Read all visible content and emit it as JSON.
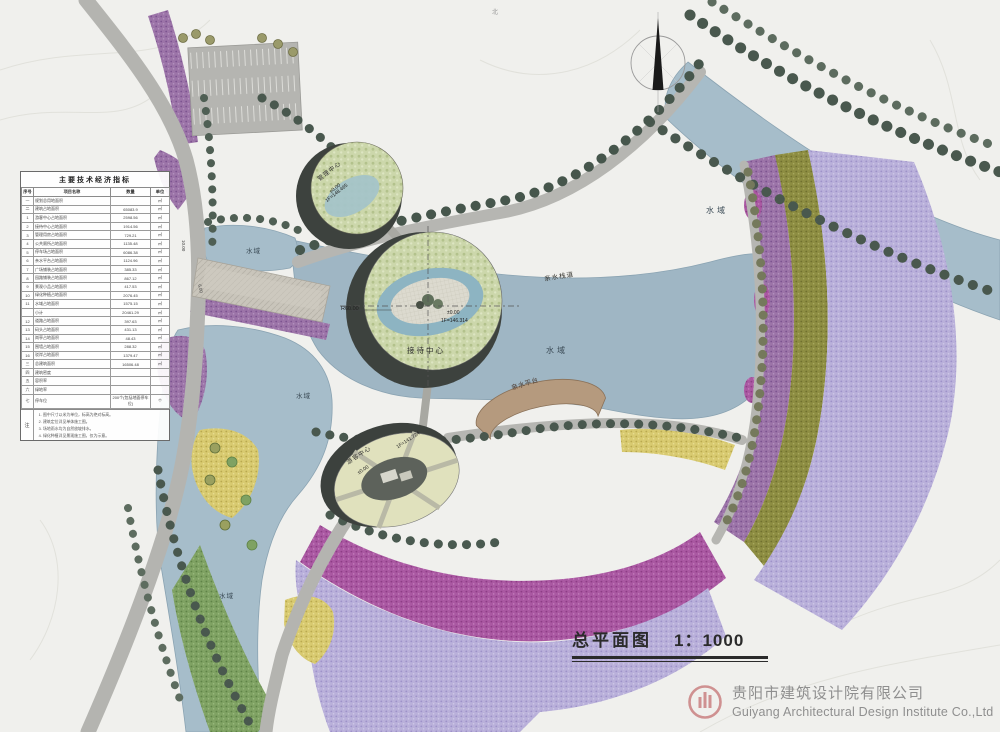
{
  "sheet": {
    "title": "总平面图",
    "scale": "1：1000",
    "company_cn": "贵阳市建筑设计院有限公司",
    "company_en": "Guiyang Architectural Design Institute Co.,Ltd",
    "north_mark": "北"
  },
  "table": {
    "title": "主要技术经济指标",
    "headers": [
      "序号",
      "项目名称",
      "数量",
      "单位"
    ],
    "rows": [
      [
        "一",
        "规划总用地面积",
        "",
        "㎡"
      ],
      [
        "二",
        "建筑占地面积",
        "65083.9",
        "㎡"
      ],
      [
        "1",
        "游客中心占地面积",
        "2598.56",
        "㎡"
      ],
      [
        "2",
        "接待中心占地面积",
        "1914.56",
        "㎡"
      ],
      [
        "3",
        "管理用房占地面积",
        "729.21",
        "㎡"
      ],
      [
        "4",
        "公共厕所占地面积",
        "1135.48",
        "㎡"
      ],
      [
        "5",
        "停车场占地面积",
        "6086.38",
        "㎡"
      ],
      [
        "6",
        "亲水平台占地面积",
        "1124.96",
        "㎡"
      ],
      [
        "7",
        "广场铺装占地面积",
        "385.33",
        "㎡"
      ],
      [
        "8",
        "园路铺装占地面积",
        "867.12",
        "㎡"
      ],
      [
        "9",
        "景观小品占地面积",
        "417.53",
        "㎡"
      ],
      [
        "10",
        "绿化种植占地面积",
        "2076.45",
        "㎡"
      ],
      [
        "11",
        "水域占地面积",
        "1575.15",
        "㎡"
      ],
      [
        "",
        "小计",
        "20461.29",
        "㎡"
      ],
      [
        "12",
        "道路占地面积",
        "397.63",
        "㎡"
      ],
      [
        "13",
        "码头占地面积",
        "431.13",
        "㎡"
      ],
      [
        "14",
        "岗亭占地面积",
        "48.43",
        "㎡"
      ],
      [
        "15",
        "围墙占地面积",
        "288.32",
        "㎡"
      ],
      [
        "16",
        "驳岸占地面积",
        "1379.47",
        "㎡"
      ],
      [
        "三",
        "总建筑面积",
        "16506.48",
        "㎡"
      ],
      [
        "四",
        "建筑密度",
        "",
        ""
      ],
      [
        "五",
        "容积率",
        "",
        ""
      ],
      [
        "六",
        "绿地率",
        "",
        ""
      ],
      [
        "七",
        "停车位",
        "200个(包括地面停车位)",
        "个"
      ]
    ],
    "notes_key": "注",
    "notes": [
      "图中尺寸以米为单位，标高为绝对标高。",
      "建筑定位详见单体施工图。",
      "场地雨水均为自然放坡排水。",
      "绿化种植详见景观施工图，仅为示意。"
    ]
  },
  "map_labels": [
    {
      "name": "water-label-ne",
      "text": "水域",
      "x": 706,
      "y": 207,
      "rot": 0,
      "size": 8,
      "ls": 3,
      "color": "#3a4a55"
    },
    {
      "name": "water-label-center",
      "text": "水域",
      "x": 546,
      "y": 347,
      "rot": 0,
      "size": 8,
      "ls": 3,
      "color": "#3a4a55"
    },
    {
      "name": "water-label-north-pond",
      "text": "水域",
      "x": 246,
      "y": 249,
      "rot": 0,
      "size": 6.5,
      "ls": 1,
      "color": "#3a4a55"
    },
    {
      "name": "water-label-west",
      "text": "水域",
      "x": 296,
      "y": 394,
      "rot": 0,
      "size": 6.5,
      "ls": 1,
      "color": "#3a4a55"
    },
    {
      "name": "water-label-south",
      "text": "水域",
      "x": 219,
      "y": 594,
      "rot": 0,
      "size": 6.5,
      "ls": 1,
      "color": "#3a4a55"
    },
    {
      "name": "boardwalk-label",
      "text": "亲水栈道",
      "x": 544,
      "y": 277,
      "rot": -9,
      "size": 6.5,
      "ls": 1,
      "color": "#33332e"
    },
    {
      "name": "platform-label",
      "text": "亲水平台",
      "x": 511,
      "y": 386,
      "rot": -17,
      "size": 6.5,
      "ls": 0.5,
      "color": "#4a3a30"
    },
    {
      "name": "reception-center-label",
      "text": "接待中心",
      "x": 407,
      "y": 347,
      "rot": 0,
      "size": 7.5,
      "ls": 2,
      "color": "#2e2e2e"
    },
    {
      "name": "radius-label",
      "text": "R60.00",
      "x": 341,
      "y": 307,
      "rot": 0,
      "size": 5.5,
      "ls": 0,
      "color": "#222222"
    },
    {
      "name": "center-elev-label-1",
      "text": "±0.00",
      "x": 447,
      "y": 311,
      "rot": 0,
      "size": 5,
      "ls": 0,
      "color": "#222222"
    },
    {
      "name": "center-elev-label-2",
      "text": "1F=146.314",
      "x": 441,
      "y": 319,
      "rot": 0,
      "size": 5,
      "ls": 0,
      "color": "#222222"
    },
    {
      "name": "management-center-label",
      "text": "管理中心",
      "x": 317,
      "y": 178,
      "rot": -38,
      "size": 6,
      "ls": 1,
      "color": "#2e2e2e"
    },
    {
      "name": "upper-elev-label-1",
      "text": "±0.00",
      "x": 329,
      "y": 191,
      "rot": -38,
      "size": 5,
      "ls": 0,
      "color": "#222222"
    },
    {
      "name": "upper-elev-label-2",
      "text": "1F=148.465",
      "x": 325,
      "y": 200,
      "rot": -38,
      "size": 5,
      "ls": 0,
      "color": "#222222"
    },
    {
      "name": "visitor-center-label",
      "text": "游客中心",
      "x": 346,
      "y": 461,
      "rot": -33,
      "size": 6,
      "ls": 1,
      "color": "#2e2e2e"
    },
    {
      "name": "lower-elev-label-1",
      "text": "±0.00",
      "x": 357,
      "y": 472,
      "rot": -33,
      "size": 5,
      "ls": 0,
      "color": "#222222"
    },
    {
      "name": "lower-elev-label-2",
      "text": "1F=141.724",
      "x": 396,
      "y": 446,
      "rot": -33,
      "size": 5,
      "ls": 0,
      "color": "#222222"
    },
    {
      "name": "road-dim-label-1",
      "text": "10.00",
      "x": 185,
      "y": 240,
      "rot": 90,
      "size": 4.5,
      "ls": 0,
      "color": "#444444"
    },
    {
      "name": "road-dim-label-2",
      "text": "6.00",
      "x": 201,
      "y": 284,
      "rot": 78,
      "size": 4.5,
      "ls": 0,
      "color": "#444444"
    },
    {
      "name": "north-text",
      "text": "北",
      "x": 492,
      "y": 10,
      "rot": 0,
      "size": 6,
      "ls": 0,
      "color": "#999999"
    }
  ],
  "colors": {
    "paper": "#f0f0ed",
    "water": "#a6bdca",
    "road": "#b4b4b0",
    "tree_dark": "#4a5a50",
    "band_purple": "#9c74a8",
    "band_magenta": "#aa58a2",
    "band_lavender": "#b9b0da",
    "band_olive": "#8d8d42",
    "band_yellow": "#d8ca70",
    "band_green": "#7fa263",
    "roof_green": "#ccd7ab",
    "building_shadow": "#3d423e",
    "platform_tan": "#b59a7e",
    "logo_red": "#cf9191",
    "title_ink": "#2b2b2b"
  }
}
